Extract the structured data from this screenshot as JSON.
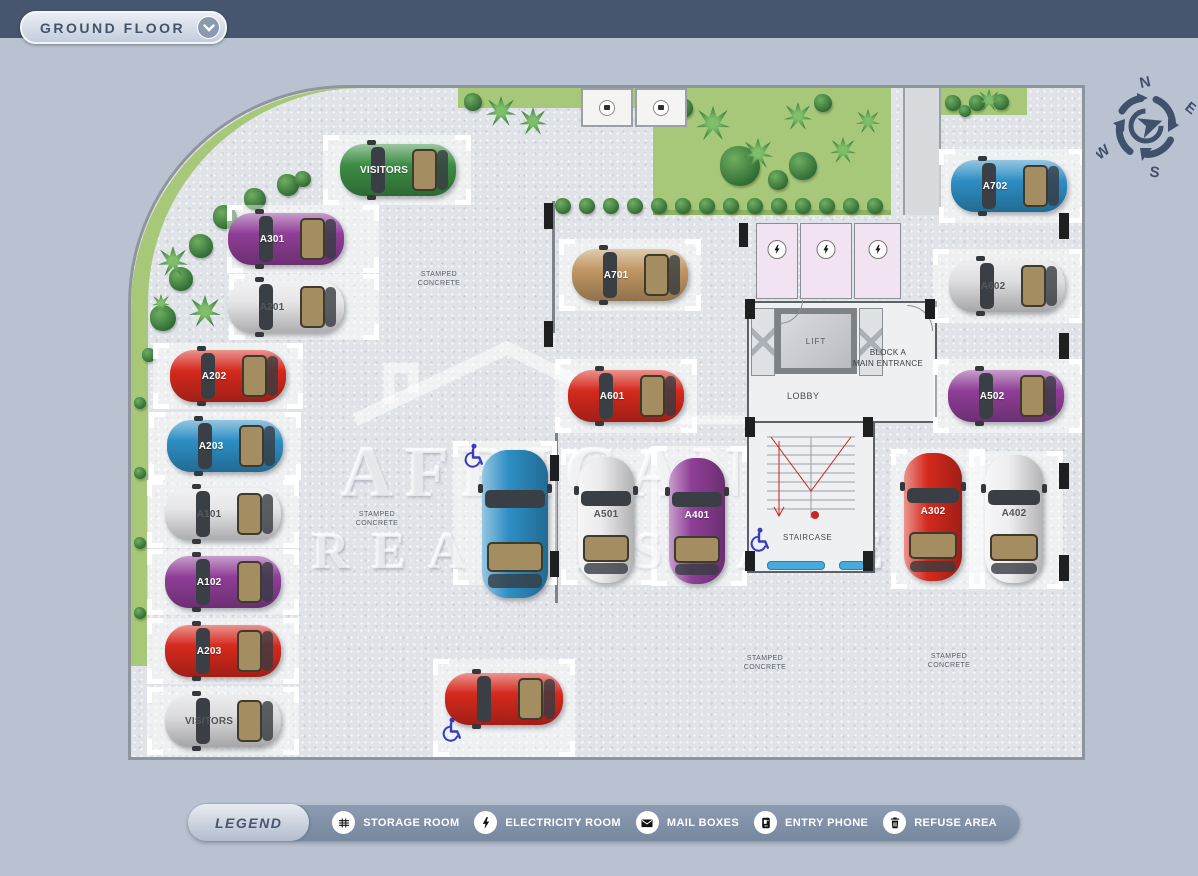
{
  "header": {
    "title": "GROUND FLOOR"
  },
  "compass": {
    "n": "N",
    "e": "E",
    "s": "S",
    "w": "W"
  },
  "watermark": {
    "line1": "AFRICANOS",
    "line2": "REAL ESTATE"
  },
  "plan": {
    "rooms": {
      "lift": "LIFT",
      "lobby": "LOBBY",
      "entrance_line1": "BLOCK A",
      "entrance_line2": "MAIN ENTRANCE",
      "staircase": "STAIRCASE"
    },
    "surface_label": {
      "line1": "STAMPED",
      "line2": "CONCRETE",
      "positions": [
        [
          308,
          191
        ],
        [
          246,
          431
        ],
        [
          634,
          575
        ],
        [
          818,
          573
        ]
      ]
    },
    "cars": [
      {
        "label": "VISITORS",
        "color": "#3c8d45",
        "light": false,
        "orient": "h",
        "x": 209,
        "y": 56,
        "len": 116,
        "wid": 52,
        "spot": [
          192,
          47,
          148,
          70
        ]
      },
      {
        "label": "A301",
        "color": "#8f3e97",
        "light": false,
        "orient": "h",
        "x": 97,
        "y": 125,
        "len": 116,
        "wid": 52,
        "spot": [
          96,
          117,
          152,
          68
        ]
      },
      {
        "label": "A201",
        "color": "#e6e6e8",
        "light": true,
        "orient": "h",
        "x": 97,
        "y": 193,
        "len": 116,
        "wid": 52,
        "spot": [
          98,
          186,
          150,
          66
        ]
      },
      {
        "label": "A202",
        "color": "#d5291d",
        "light": false,
        "orient": "h",
        "x": 39,
        "y": 262,
        "len": 116,
        "wid": 52,
        "spot": [
          22,
          255,
          150,
          66
        ]
      },
      {
        "label": "A203",
        "color": "#2d8ec4",
        "light": false,
        "orient": "h",
        "x": 36,
        "y": 332,
        "len": 116,
        "wid": 52,
        "spot": [
          18,
          324,
          152,
          68
        ]
      },
      {
        "label": "A101",
        "color": "#e6e6e8",
        "light": true,
        "orient": "h",
        "x": 34,
        "y": 400,
        "len": 116,
        "wid": 52,
        "spot": [
          16,
          392,
          152,
          68
        ]
      },
      {
        "label": "A102",
        "color": "#8f3e97",
        "light": false,
        "orient": "h",
        "x": 34,
        "y": 468,
        "len": 116,
        "wid": 52,
        "spot": [
          16,
          461,
          152,
          66
        ]
      },
      {
        "label": "A203",
        "color": "#d5291d",
        "light": false,
        "orient": "h",
        "x": 34,
        "y": 537,
        "len": 116,
        "wid": 52,
        "spot": [
          16,
          530,
          152,
          66
        ]
      },
      {
        "label": "VISITORS",
        "color": "#dcdcde",
        "light": true,
        "orient": "h",
        "x": 34,
        "y": 607,
        "len": 116,
        "wid": 52,
        "spot": [
          16,
          599,
          152,
          68
        ]
      },
      {
        "label": "A701",
        "color": "#c09764",
        "light": false,
        "orient": "h",
        "x": 441,
        "y": 161,
        "len": 116,
        "wid": 52,
        "spot": [
          428,
          151,
          142,
          72
        ]
      },
      {
        "label": "A601",
        "color": "#d5291d",
        "light": false,
        "orient": "h",
        "x": 437,
        "y": 282,
        "len": 116,
        "wid": 52,
        "spot": [
          424,
          271,
          142,
          74
        ]
      },
      {
        "label": "",
        "color": "#2d8ec4",
        "light": false,
        "orient": "v",
        "x": 351,
        "y": 362,
        "len": 148,
        "wid": 66,
        "spot": [
          322,
          353,
          104,
          144
        ]
      },
      {
        "label": "A501",
        "color": "#ececee",
        "light": true,
        "orient": "v",
        "x": 447,
        "y": 369,
        "len": 126,
        "wid": 56,
        "spot": [
          430,
          361,
          96,
          136
        ]
      },
      {
        "label": "A401",
        "color": "#8f3e97",
        "light": false,
        "orient": "v",
        "x": 538,
        "y": 370,
        "len": 126,
        "wid": 56,
        "spot": [
          520,
          358,
          96,
          140
        ]
      },
      {
        "label": "A702",
        "color": "#2d8ec4",
        "light": false,
        "orient": "h",
        "x": 820,
        "y": 72,
        "len": 116,
        "wid": 52,
        "spot": [
          808,
          61,
          146,
          74
        ]
      },
      {
        "label": "A602",
        "color": "#dedee0",
        "light": true,
        "orient": "h",
        "x": 818,
        "y": 172,
        "len": 116,
        "wid": 52,
        "spot": [
          802,
          161,
          152,
          74
        ]
      },
      {
        "label": "A502",
        "color": "#8f3e97",
        "light": false,
        "orient": "h",
        "x": 817,
        "y": 282,
        "len": 116,
        "wid": 52,
        "spot": [
          802,
          271,
          152,
          74
        ]
      },
      {
        "label": "A302",
        "color": "#d5291d",
        "light": false,
        "orient": "v",
        "x": 773,
        "y": 365,
        "len": 128,
        "wid": 58,
        "spot": [
          760,
          361,
          94,
          140
        ]
      },
      {
        "label": "A402",
        "color": "#efeff1",
        "light": true,
        "orient": "v",
        "x": 854,
        "y": 367,
        "len": 128,
        "wid": 58,
        "spot": [
          838,
          363,
          94,
          138
        ]
      },
      {
        "label": "",
        "color": "#d5291d",
        "light": false,
        "orient": "h",
        "x": 314,
        "y": 585,
        "len": 118,
        "wid": 52,
        "spot": [
          302,
          571,
          142,
          98
        ]
      }
    ],
    "electricity_rooms": [
      [
        625,
        135,
        42,
        76
      ],
      [
        669,
        135,
        52,
        76
      ],
      [
        723,
        135,
        47,
        76
      ]
    ],
    "utility_boxes": [
      [
        450,
        0,
        52,
        39
      ],
      [
        504,
        0,
        52,
        39
      ]
    ],
    "handicap_icons": [
      [
        342,
        368
      ],
      [
        320,
        642
      ],
      [
        628,
        452
      ]
    ],
    "pillars": [
      [
        413,
        115,
        9,
        26
      ],
      [
        413,
        233,
        9,
        26
      ],
      [
        419,
        367,
        9,
        26
      ],
      [
        419,
        463,
        9,
        26
      ],
      [
        608,
        135,
        9,
        24
      ],
      [
        928,
        125,
        10,
        26
      ],
      [
        928,
        245,
        10,
        26
      ],
      [
        928,
        375,
        10,
        26
      ],
      [
        928,
        467,
        10,
        26
      ],
      [
        614,
        211,
        10,
        20
      ],
      [
        794,
        211,
        10,
        20
      ],
      [
        614,
        329,
        10,
        20
      ],
      [
        732,
        329,
        10,
        20
      ],
      [
        614,
        463,
        10,
        20
      ],
      [
        732,
        463,
        10,
        20
      ]
    ],
    "trees": [
      [
        32,
        230,
        13,
        "round"
      ],
      [
        50,
        191,
        12,
        "round"
      ],
      [
        70,
        158,
        12,
        "round"
      ],
      [
        94,
        129,
        12,
        "round"
      ],
      [
        124,
        111,
        11,
        "round"
      ],
      [
        157,
        97,
        11,
        "round"
      ],
      [
        18,
        267,
        7,
        "round"
      ],
      [
        172,
        91,
        8,
        "round"
      ],
      [
        42,
        173,
        15,
        "palm"
      ],
      [
        74,
        223,
        16,
        "palm"
      ],
      [
        30,
        215,
        9,
        "palm"
      ],
      [
        370,
        23,
        15,
        "palm"
      ],
      [
        402,
        33,
        14,
        "palm"
      ],
      [
        342,
        14,
        9,
        "round"
      ],
      [
        552,
        20,
        10,
        "round"
      ],
      [
        609,
        78,
        20,
        "round"
      ],
      [
        672,
        78,
        14,
        "round"
      ],
      [
        692,
        15,
        9,
        "round"
      ],
      [
        647,
        92,
        10,
        "round"
      ],
      [
        582,
        35,
        17,
        "palm"
      ],
      [
        627,
        65,
        15,
        "palm"
      ],
      [
        667,
        28,
        14,
        "palm"
      ],
      [
        712,
        62,
        13,
        "palm"
      ],
      [
        737,
        33,
        12,
        "palm"
      ],
      [
        432,
        118,
        8,
        "round"
      ],
      [
        456,
        118,
        8,
        "round"
      ],
      [
        480,
        118,
        8,
        "round"
      ],
      [
        504,
        118,
        8,
        "round"
      ],
      [
        528,
        118,
        8,
        "round"
      ],
      [
        552,
        118,
        8,
        "round"
      ],
      [
        576,
        118,
        8,
        "round"
      ],
      [
        600,
        118,
        8,
        "round"
      ],
      [
        624,
        118,
        8,
        "round"
      ],
      [
        648,
        118,
        8,
        "round"
      ],
      [
        672,
        118,
        8,
        "round"
      ],
      [
        696,
        118,
        8,
        "round"
      ],
      [
        720,
        118,
        8,
        "round"
      ],
      [
        744,
        118,
        8,
        "round"
      ],
      [
        822,
        15,
        8,
        "round"
      ],
      [
        846,
        15,
        8,
        "round"
      ],
      [
        870,
        14,
        8,
        "round"
      ],
      [
        834,
        23,
        6,
        "round"
      ],
      [
        858,
        12,
        11,
        "palm"
      ],
      [
        9,
        315,
        6,
        "round"
      ],
      [
        9,
        385,
        6,
        "round"
      ],
      [
        9,
        455,
        6,
        "round"
      ],
      [
        9,
        525,
        6,
        "round"
      ]
    ]
  },
  "legend": {
    "title": "LEGEND",
    "items": [
      {
        "icon": "storage-room-icon",
        "label": "STORAGE ROOM"
      },
      {
        "icon": "electricity-room-icon",
        "label": "ELECTRICITY ROOM"
      },
      {
        "icon": "mail-boxes-icon",
        "label": "MAIL BOXES"
      },
      {
        "icon": "entry-phone-icon",
        "label": "ENTRY PHONE"
      },
      {
        "icon": "refuse-area-icon",
        "label": "REFUSE AREA"
      }
    ]
  },
  "colors": {
    "top_bar": "#47566e",
    "page_bg": "#b8c2d1",
    "plan_bg": "#e0e3e7",
    "green": "#a6c878",
    "legend_bar": "#8292a8",
    "electricity_room": "#f1e3f1",
    "handicap_blue": "#3a3ac0"
  }
}
